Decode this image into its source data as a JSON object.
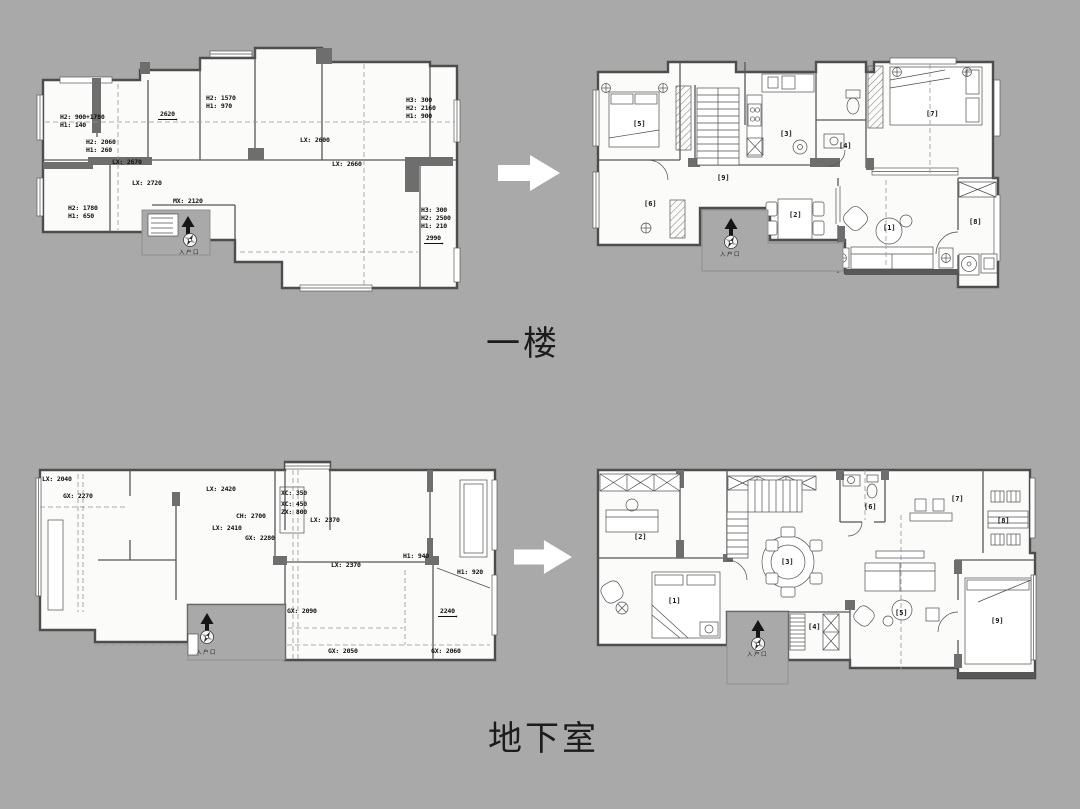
{
  "colors": {
    "background": "#a9a9a9",
    "wall": "#4d4d4d",
    "floor": "#fbfbfa",
    "arrow": "#ffffff"
  },
  "captions": {
    "first_floor": "一楼",
    "basement": "地下室"
  },
  "plans": {
    "tl": {
      "labels": [
        {
          "t": "H2: 900+1780\nH1: 140",
          "x": 60,
          "y": 113
        },
        {
          "t": "H2: 2060\nH1: 260",
          "x": 86,
          "y": 138
        },
        {
          "t": "2620",
          "x": 158,
          "y": 110,
          "u": true
        },
        {
          "t": "H2: 1570\nH1: 970",
          "x": 206,
          "y": 94
        },
        {
          "t": "LX: 2600",
          "x": 300,
          "y": 136
        },
        {
          "t": "LX: 2660",
          "x": 332,
          "y": 160
        },
        {
          "t": "H3: 300\nH2: 2160\nH1: 900",
          "x": 406,
          "y": 96
        },
        {
          "t": "LX: 2670",
          "x": 112,
          "y": 158
        },
        {
          "t": "LX: 2720",
          "x": 132,
          "y": 179
        },
        {
          "t": "MX: 2120",
          "x": 173,
          "y": 197
        },
        {
          "t": "H2: 1780\nH1: 650",
          "x": 68,
          "y": 204
        },
        {
          "t": "H3: 300\nH2: 2500\nH1: 210",
          "x": 421,
          "y": 206
        },
        {
          "t": "2990",
          "x": 424,
          "y": 234,
          "u": true
        },
        {
          "t": "入户口",
          "x": 179,
          "y": 250,
          "k": "tiny"
        }
      ]
    },
    "tr": {
      "labels": [
        {
          "t": "[5]",
          "x": 633,
          "y": 120,
          "k": "room"
        },
        {
          "t": "[6]",
          "x": 644,
          "y": 200,
          "k": "room"
        },
        {
          "t": "[9]",
          "x": 717,
          "y": 174,
          "k": "room"
        },
        {
          "t": "[3]",
          "x": 780,
          "y": 130,
          "k": "room"
        },
        {
          "t": "[4]",
          "x": 839,
          "y": 142,
          "k": "room"
        },
        {
          "t": "[2]",
          "x": 789,
          "y": 211,
          "k": "room"
        },
        {
          "t": "[1]",
          "x": 883,
          "y": 224,
          "k": "room"
        },
        {
          "t": "[7]",
          "x": 926,
          "y": 110,
          "k": "room"
        },
        {
          "t": "[8]",
          "x": 969,
          "y": 218,
          "k": "room"
        },
        {
          "t": "入户口",
          "x": 720,
          "y": 252,
          "k": "tiny"
        }
      ]
    },
    "bl": {
      "labels": [
        {
          "t": "LX: 2040",
          "x": 42,
          "y": 475
        },
        {
          "t": "GX: 2270",
          "x": 63,
          "y": 492
        },
        {
          "t": "LX: 2420",
          "x": 206,
          "y": 485
        },
        {
          "t": "CH: 2700",
          "x": 236,
          "y": 512
        },
        {
          "t": "LX: 2410",
          "x": 212,
          "y": 524
        },
        {
          "t": "GX: 2280",
          "x": 245,
          "y": 534
        },
        {
          "t": "XC: 350",
          "x": 281,
          "y": 489
        },
        {
          "t": "XC: 450",
          "x": 281,
          "y": 500
        },
        {
          "t": "ZX: 800",
          "x": 281,
          "y": 508
        },
        {
          "t": "LX: 2370",
          "x": 310,
          "y": 516
        },
        {
          "t": "LX: 2370",
          "x": 331,
          "y": 561
        },
        {
          "t": "H1: 940",
          "x": 403,
          "y": 552
        },
        {
          "t": "H1: 920",
          "x": 457,
          "y": 568
        },
        {
          "t": "2240",
          "x": 438,
          "y": 607,
          "u": true
        },
        {
          "t": "GX: 2090",
          "x": 287,
          "y": 607
        },
        {
          "t": "GX: 2050",
          "x": 328,
          "y": 647
        },
        {
          "t": "GX: 2060",
          "x": 431,
          "y": 647
        },
        {
          "t": "入户口",
          "x": 196,
          "y": 650,
          "k": "tiny"
        }
      ]
    },
    "br": {
      "labels": [
        {
          "t": "[2]",
          "x": 634,
          "y": 533,
          "k": "room"
        },
        {
          "t": "[1]",
          "x": 668,
          "y": 597,
          "k": "room"
        },
        {
          "t": "[3]",
          "x": 781,
          "y": 558,
          "k": "room"
        },
        {
          "t": "[4]",
          "x": 808,
          "y": 623,
          "k": "room"
        },
        {
          "t": "[6]",
          "x": 864,
          "y": 503,
          "k": "room"
        },
        {
          "t": "[7]",
          "x": 951,
          "y": 495,
          "k": "room"
        },
        {
          "t": "[8]",
          "x": 997,
          "y": 517,
          "k": "room"
        },
        {
          "t": "[5]",
          "x": 895,
          "y": 609,
          "k": "room"
        },
        {
          "t": "[9]",
          "x": 991,
          "y": 617,
          "k": "room"
        },
        {
          "t": "入户口",
          "x": 747,
          "y": 652,
          "k": "tiny"
        }
      ]
    }
  }
}
